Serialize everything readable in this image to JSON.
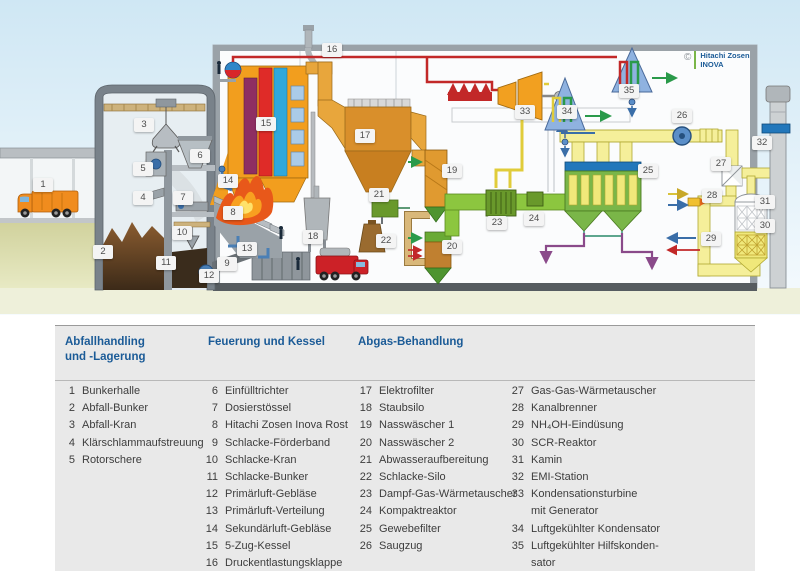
{
  "diagram": {
    "logo": {
      "copyright": "©",
      "name": "Hitachi Zosen\nINOVA"
    },
    "badges": [
      {
        "n": "1",
        "x": 43,
        "y": 185
      },
      {
        "n": "2",
        "x": 103,
        "y": 252
      },
      {
        "n": "3",
        "x": 144,
        "y": 125
      },
      {
        "n": "4",
        "x": 143,
        "y": 198
      },
      {
        "n": "5",
        "x": 143,
        "y": 169
      },
      {
        "n": "6",
        "x": 200,
        "y": 156
      },
      {
        "n": "7",
        "x": 183,
        "y": 198
      },
      {
        "n": "8",
        "x": 233,
        "y": 213
      },
      {
        "n": "9",
        "x": 227,
        "y": 264
      },
      {
        "n": "10",
        "x": 182,
        "y": 233
      },
      {
        "n": "11",
        "x": 166,
        "y": 263
      },
      {
        "n": "12",
        "x": 209,
        "y": 276
      },
      {
        "n": "13",
        "x": 247,
        "y": 249
      },
      {
        "n": "14",
        "x": 228,
        "y": 181
      },
      {
        "n": "15",
        "x": 266,
        "y": 124
      },
      {
        "n": "16",
        "x": 332,
        "y": 50
      },
      {
        "n": "17",
        "x": 365,
        "y": 136
      },
      {
        "n": "18",
        "x": 313,
        "y": 237
      },
      {
        "n": "19",
        "x": 452,
        "y": 171
      },
      {
        "n": "20",
        "x": 452,
        "y": 247
      },
      {
        "n": "21",
        "x": 379,
        "y": 195
      },
      {
        "n": "22",
        "x": 386,
        "y": 241
      },
      {
        "n": "23",
        "x": 497,
        "y": 223
      },
      {
        "n": "24",
        "x": 534,
        "y": 219
      },
      {
        "n": "25",
        "x": 648,
        "y": 171
      },
      {
        "n": "26",
        "x": 682,
        "y": 116
      },
      {
        "n": "27",
        "x": 721,
        "y": 164
      },
      {
        "n": "28",
        "x": 712,
        "y": 196
      },
      {
        "n": "29",
        "x": 711,
        "y": 239
      },
      {
        "n": "30",
        "x": 765,
        "y": 226
      },
      {
        "n": "31",
        "x": 765,
        "y": 202
      },
      {
        "n": "32",
        "x": 762,
        "y": 143
      },
      {
        "n": "33",
        "x": 525,
        "y": 112
      },
      {
        "n": "34",
        "x": 567,
        "y": 112
      },
      {
        "n": "35",
        "x": 629,
        "y": 91
      }
    ]
  },
  "legend": {
    "headers": [
      {
        "title": "Abfallhandling\nund -Lagerung"
      },
      {
        "title": "Feuerung und Kessel"
      },
      {
        "title": "Abgas-Behandlung"
      }
    ],
    "columns": [
      [
        {
          "n": "1",
          "t": "Bunkerhalle"
        },
        {
          "n": "2",
          "t": "Abfall-Bunker"
        },
        {
          "n": "3",
          "t": "Abfall-Kran"
        },
        {
          "n": "4",
          "t": "Klärschlammaufstreuung"
        },
        {
          "n": "5",
          "t": "Rotorschere"
        }
      ],
      [
        {
          "n": "6",
          "t": "Einfülltrichter"
        },
        {
          "n": "7",
          "t": "Dosierstössel"
        },
        {
          "n": "8",
          "t": "Hitachi Zosen Inova Rost"
        },
        {
          "n": "9",
          "t": "Schlacke-Förderband"
        },
        {
          "n": "10",
          "t": "Schlacke-Kran"
        },
        {
          "n": "11",
          "t": "Schlacke-Bunker"
        },
        {
          "n": "12",
          "t": "Primärluft-Gebläse"
        },
        {
          "n": "13",
          "t": "Primärluft-Verteilung"
        },
        {
          "n": "14",
          "t": "Sekundärluft-Gebläse"
        },
        {
          "n": "15",
          "t": "5-Zug-Kessel"
        },
        {
          "n": "16",
          "t": "Druckentlastungsklappe"
        }
      ],
      [
        {
          "n": "17",
          "t": "Elektrofilter"
        },
        {
          "n": "18",
          "t": "Staubsilo"
        },
        {
          "n": "19",
          "t": "Nasswäscher 1"
        },
        {
          "n": "20",
          "t": "Nasswäscher 2"
        },
        {
          "n": "21",
          "t": "Abwasseraufbereitung"
        },
        {
          "n": "22",
          "t": "Schlacke-Silo"
        },
        {
          "n": "23",
          "t": "Dampf-Gas-Wärmetauscher"
        },
        {
          "n": "24",
          "t": "Kompaktreaktor"
        },
        {
          "n": "25",
          "t": "Gewebefilter"
        },
        {
          "n": "26",
          "t": "Saugzug"
        }
      ],
      [
        {
          "n": "27",
          "t": "Gas-Gas-Wärmetauscher"
        },
        {
          "n": "28",
          "t": "Kanalbrenner"
        },
        {
          "n": "29",
          "t": "NH₄OH-Eindüsung"
        },
        {
          "n": "30",
          "t": "SCR-Reaktor"
        },
        {
          "n": "31",
          "t": "Kamin"
        },
        {
          "n": "32",
          "t": "EMI-Station"
        },
        {
          "n": "33",
          "t": "Kondensationsturbine\nmit Generator"
        },
        {
          "n": "34",
          "t": "Luftgekühlter Kondensator"
        },
        {
          "n": "35",
          "t": "Luftgekühlter Hilfskonden-\nsator"
        }
      ]
    ]
  },
  "palette": {
    "sky_top": "#cfe7f4",
    "sky_bottom": "#f6fbfe",
    "ground_khaki": "#d8d9a6",
    "ground_strip": "#eef0da",
    "boiler_orange": "#f29e1e",
    "band_purple": "#8e2e62",
    "band_red": "#df2b28",
    "band_blue": "#2fa8dc",
    "flue_green_duct": "#8cc63f",
    "process_green": "#69992b",
    "clean_gas_yellow": "#f5ef9a",
    "steam_red": "#c22828",
    "steam_yellow": "#e0cc3a",
    "water_blue": "#3a6ea8",
    "residue_purple": "#8a4a8a",
    "condenser_blue": "#8fb2e0",
    "gray_structure": "#79828a",
    "legend_header_blue": "#1b5b97",
    "legend_bg": "#e9e9e9",
    "logo_green": "#7ab648"
  }
}
